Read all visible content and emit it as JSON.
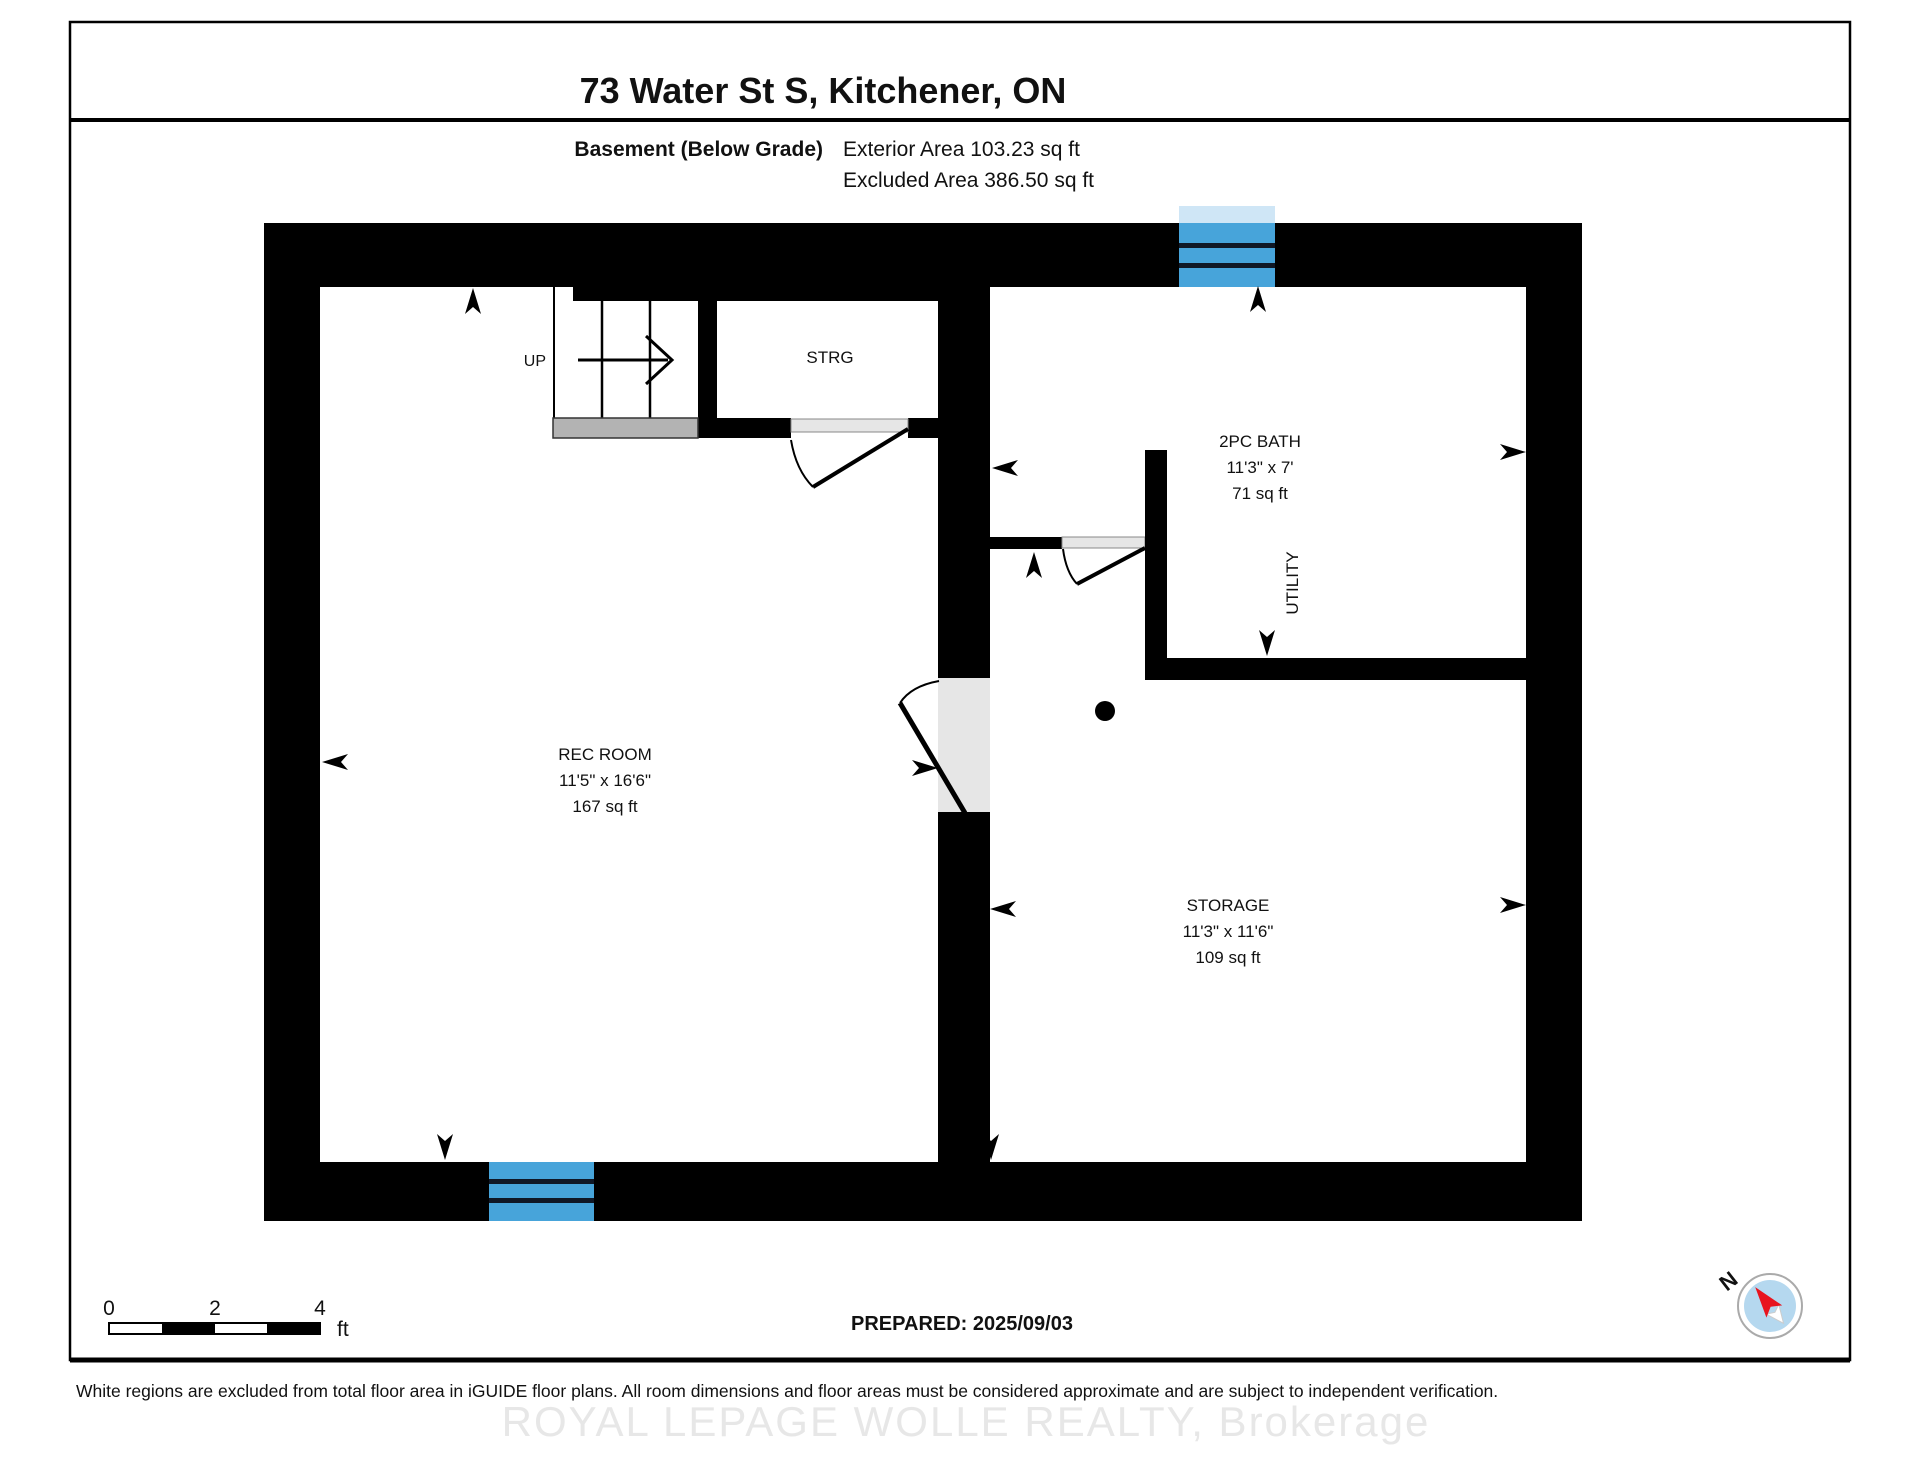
{
  "header": {
    "title": "73 Water St S, Kitchener, ON",
    "floor_label": "Basement (Below Grade)",
    "exterior_area": "Exterior Area 103.23 sq ft",
    "excluded_area": "Excluded Area 386.50 sq ft"
  },
  "rooms": {
    "rec_room": {
      "name": "REC ROOM",
      "dimensions": "11'5\" x 16'6\"",
      "area": "167 sq ft"
    },
    "storage": {
      "name": "STORAGE",
      "dimensions": "11'3\" x 11'6\"",
      "area": "109 sq ft"
    },
    "bath": {
      "name": "2PC BATH",
      "dimensions": "11'3\" x 7'",
      "area": "71 sq ft"
    },
    "utility": {
      "name": "UTILITY"
    },
    "strg": {
      "name": "STRG"
    },
    "stairs": {
      "label": "UP"
    }
  },
  "scale_bar": {
    "tick_0": "0",
    "tick_2": "2",
    "tick_4": "4",
    "unit": "ft"
  },
  "footer": {
    "prepared": "PREPARED: 2025/09/03",
    "disclaimer": "White regions are excluded from total floor area in iGUIDE floor plans. All room dimensions and floor areas must be considered approximate and are subject to independent verification.",
    "watermark": "ROYAL LEPAGE WOLLE REALTY, Brokerage"
  },
  "compass": {
    "north_label": "N"
  },
  "icons": {
    "compass": "compass-north-icon",
    "column": "column-dot-icon",
    "stair_arrow": "stair-direction-arrow-icon",
    "dimension_arrow": "dimension-arrow-icon",
    "window": "window-icon",
    "door": "door-swing-icon"
  },
  "colors": {
    "wall": "#000000",
    "window_blue": "#47a4da",
    "window_pale": "#cfe6f6",
    "door_gray": "#e6e6e6",
    "landing_gray": "#b3b3b3",
    "compass_blue": "#b5d8ef",
    "compass_red": "#e8141e",
    "watermark_gray": "#e7e7e7"
  }
}
